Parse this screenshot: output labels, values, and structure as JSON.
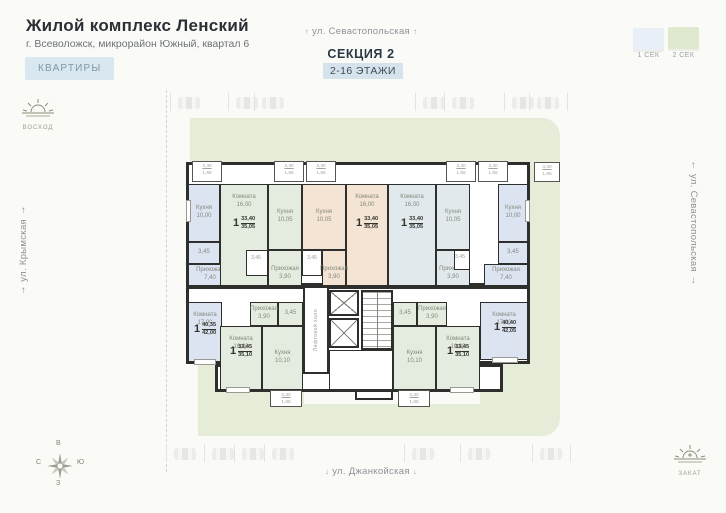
{
  "header": {
    "title": "Жилой комплекс Ленский",
    "subtitle": "г. Всеволожск, микрорайон Южный, квартал 6",
    "apartments_button": "КВАРТИРЫ"
  },
  "section": {
    "name": "СЕКЦИЯ 2",
    "floors": "2-16 ЭТАЖИ"
  },
  "legend": {
    "items": [
      {
        "label": "1 СЕК",
        "color": "#e9eff7"
      },
      {
        "label": "2 СЕК",
        "color": "#dfe9d0"
      }
    ]
  },
  "streets": {
    "top": "ул. Севастопольская",
    "left": "ул. Крымская",
    "right": "ул. Севастопольская",
    "bottom": "ул. Джанкойская",
    "arrow_up": "↑",
    "arrow_down": "↓"
  },
  "sun": {
    "sunrise": "ВОСХОД",
    "sunset": "ЗАКАТ"
  },
  "compass": {
    "top": "В",
    "left": "С",
    "right": "Ю",
    "bottom": "З"
  },
  "plan": {
    "core_label": "Лифтовой холл",
    "colors": {
      "wall": "#2e2e2c",
      "lawn": "#e5edd9",
      "sec1": "#dde4f1",
      "sec2": "#e4ecdf",
      "beige": "#f4e4d4",
      "pale": "#e1e9ec"
    },
    "lawns": [
      {
        "x": 32,
        "y": 30,
        "w": 370,
        "h": 46,
        "r": "0 18px 0 0"
      },
      {
        "x": 372,
        "y": 76,
        "w": 30,
        "h": 272,
        "r": "0 0 18px 0"
      },
      {
        "x": 40,
        "y": 276,
        "w": 106,
        "h": 72
      },
      {
        "x": 322,
        "y": 274,
        "w": 50,
        "h": 74
      },
      {
        "x": 40,
        "y": 316,
        "w": 332,
        "h": 32,
        "r": "0 0 18px 0"
      }
    ],
    "shells": [
      {
        "x": 28,
        "y": 74,
        "w": 344,
        "h": 124
      },
      {
        "x": 28,
        "y": 198,
        "w": 344,
        "h": 78
      },
      {
        "x": 57,
        "y": 276,
        "w": 288,
        "h": 28
      }
    ],
    "rooms": [
      {
        "n": "Кухня",
        "a": "10,00",
        "f": "blue",
        "x": 30,
        "y": 96,
        "w": 32,
        "h": 58
      },
      {
        "n": "",
        "a": "3,45",
        "f": "blue",
        "x": 30,
        "y": 154,
        "w": 32,
        "h": 22
      },
      {
        "n": "Прихожая",
        "a": "7,40",
        "f": "blue",
        "x": 30,
        "y": 176,
        "w": 44,
        "h": 22
      },
      {
        "n": "Комната",
        "a": "16,00",
        "f": "green",
        "x": 62,
        "y": 96,
        "w": 48,
        "h": 102,
        "lp": "t"
      },
      {
        "n": "Кухня",
        "a": "10,05",
        "f": "green",
        "x": 110,
        "y": 96,
        "w": 34,
        "h": 66
      },
      {
        "n": "",
        "a": "",
        "f": "white",
        "x": 88,
        "y": 162,
        "w": 22,
        "h": 26
      },
      {
        "n": "Прихожая",
        "a": "3,90",
        "f": "green",
        "x": 110,
        "y": 162,
        "w": 34,
        "h": 36,
        "lp": "b"
      },
      {
        "n": "Кухня",
        "a": "10,05",
        "f": "beige",
        "x": 144,
        "y": 96,
        "w": 44,
        "h": 66
      },
      {
        "n": "Комната",
        "a": "16,00",
        "f": "beige",
        "x": 188,
        "y": 96,
        "w": 42,
        "h": 102,
        "lp": "t"
      },
      {
        "n": "",
        "a": "",
        "f": "white",
        "x": 144,
        "y": 162,
        "w": 20,
        "h": 26
      },
      {
        "n": "Прихожая",
        "a": "3,90",
        "f": "beige",
        "x": 164,
        "y": 162,
        "w": 24,
        "h": 36,
        "lp": "b"
      },
      {
        "n": "Комната",
        "a": "16,00",
        "f": "pale",
        "x": 230,
        "y": 96,
        "w": 48,
        "h": 102,
        "lp": "t"
      },
      {
        "n": "Кухня",
        "a": "10,05",
        "f": "pale",
        "x": 278,
        "y": 96,
        "w": 34,
        "h": 66
      },
      {
        "n": "Прихожая",
        "a": "3,90",
        "f": "pale",
        "x": 278,
        "y": 162,
        "w": 34,
        "h": 36,
        "lp": "b"
      },
      {
        "n": "",
        "a": "",
        "f": "white",
        "x": 296,
        "y": 162,
        "w": 16,
        "h": 20
      },
      {
        "n": "Кухня",
        "a": "10,00",
        "f": "blue",
        "x": 340,
        "y": 96,
        "w": 30,
        "h": 58
      },
      {
        "n": "",
        "a": "3,45",
        "f": "blue",
        "x": 340,
        "y": 154,
        "w": 30,
        "h": 22
      },
      {
        "n": "Прихожая",
        "a": "7,40",
        "f": "blue",
        "x": 326,
        "y": 176,
        "w": 44,
        "h": 22
      },
      {
        "n": "Комната",
        "a": "17,00",
        "f": "blue",
        "x": 30,
        "y": 214,
        "w": 34,
        "h": 60,
        "lp": "t"
      },
      {
        "n": "Прихожая",
        "a": "3,90",
        "f": "green",
        "x": 92,
        "y": 214,
        "w": 28,
        "h": 24
      },
      {
        "n": "",
        "a": "3,45",
        "f": "green",
        "x": 120,
        "y": 214,
        "w": 25,
        "h": 24
      },
      {
        "n": "Комната",
        "a": "16,00",
        "f": "green",
        "x": 62,
        "y": 238,
        "w": 42,
        "h": 64,
        "lp": "t"
      },
      {
        "n": "Кухня",
        "a": "10,10",
        "f": "green",
        "x": 104,
        "y": 238,
        "w": 41,
        "h": 64
      },
      {
        "n": "",
        "a": "3,45",
        "f": "green",
        "x": 235,
        "y": 214,
        "w": 24,
        "h": 24
      },
      {
        "n": "Прихожая",
        "a": "3,90",
        "f": "green",
        "x": 259,
        "y": 214,
        "w": 30,
        "h": 24
      },
      {
        "n": "Кухня",
        "a": "10,10",
        "f": "green",
        "x": 235,
        "y": 238,
        "w": 43,
        "h": 64
      },
      {
        "n": "Комната",
        "a": "16,00",
        "f": "green",
        "x": 278,
        "y": 238,
        "w": 44,
        "h": 64,
        "lp": "t"
      },
      {
        "n": "Комната",
        "a": "17,00",
        "f": "blue",
        "x": 322,
        "y": 214,
        "w": 48,
        "h": 58,
        "lp": "t"
      }
    ],
    "dims": [
      {
        "t": "3,45",
        "x": 86,
        "y": 167,
        "w": 24
      },
      {
        "t": "3,45",
        "x": 142,
        "y": 167,
        "w": 24
      },
      {
        "t": "3,45",
        "x": 290,
        "y": 166,
        "w": 24
      }
    ],
    "badges": [
      {
        "rooms": "1",
        "top": "33,40",
        "bottom": "35,05",
        "x": 66,
        "y": 128,
        "w": 40
      },
      {
        "rooms": "1",
        "top": "33,40",
        "bottom": "35,05",
        "x": 189,
        "y": 128,
        "w": 40
      },
      {
        "rooms": "1",
        "top": "33,40",
        "bottom": "35,05",
        "x": 234,
        "y": 128,
        "w": 40
      },
      {
        "rooms": "1",
        "top": "40,35",
        "bottom": "42,00",
        "x": 28,
        "y": 234,
        "w": 38
      },
      {
        "rooms": "1",
        "top": "33,45",
        "bottom": "35,10",
        "x": 64,
        "y": 256,
        "w": 38
      },
      {
        "rooms": "1",
        "top": "33,45",
        "bottom": "35,10",
        "x": 280,
        "y": 256,
        "w": 40
      },
      {
        "rooms": "1",
        "top": "40,40",
        "bottom": "42,05",
        "x": 326,
        "y": 232,
        "w": 42
      }
    ],
    "balconies": [
      {
        "x": 34,
        "y": 73,
        "w": 30,
        "h": 21,
        "d1": "3,30",
        "d2": "1,65"
      },
      {
        "x": 116,
        "y": 73,
        "w": 30,
        "h": 21,
        "d1": "3,30",
        "d2": "1,65"
      },
      {
        "x": 148,
        "y": 73,
        "w": 30,
        "h": 21,
        "d1": "3,30",
        "d2": "1,65"
      },
      {
        "x": 288,
        "y": 73,
        "w": 30,
        "h": 21,
        "d1": "3,30",
        "d2": "1,65"
      },
      {
        "x": 320,
        "y": 73,
        "w": 30,
        "h": 21,
        "d1": "3,30",
        "d2": "1,65"
      },
      {
        "x": 376,
        "y": 74,
        "w": 26,
        "h": 20,
        "d1": "3,30",
        "d2": "1,65"
      },
      {
        "x": 112,
        "y": 302,
        "w": 32,
        "h": 17,
        "d1": "3,30",
        "d2": "1,65"
      },
      {
        "x": 240,
        "y": 302,
        "w": 32,
        "h": 17,
        "d1": "3,30",
        "d2": "1,65"
      }
    ],
    "windows": [
      {
        "x": 28,
        "y": 112,
        "w": 5,
        "h": 22
      },
      {
        "x": 367,
        "y": 112,
        "w": 5,
        "h": 22
      },
      {
        "x": 36,
        "y": 271,
        "w": 22,
        "h": 6
      },
      {
        "x": 334,
        "y": 269,
        "w": 26,
        "h": 6
      },
      {
        "x": 68,
        "y": 299,
        "w": 24,
        "h": 6
      },
      {
        "x": 292,
        "y": 299,
        "w": 24,
        "h": 6
      }
    ],
    "core": {
      "hall": {
        "x": 145,
        "y": 198,
        "w": 26,
        "h": 88
      },
      "lifts": [
        {
          "x": 171,
          "y": 202,
          "w": 30,
          "h": 26
        },
        {
          "x": 171,
          "y": 230,
          "w": 30,
          "h": 30
        }
      ],
      "stairs": {
        "x": 203,
        "y": 202,
        "w": 32,
        "h": 60
      },
      "vestibule": {
        "x": 171,
        "y": 262,
        "w": 64,
        "h": 40
      },
      "porch": {
        "x": 197,
        "y": 302,
        "w": 38,
        "h": 10
      }
    },
    "parking": {
      "top_y": 97,
      "bottom_y": 448,
      "top": [
        178,
        236,
        262,
        423,
        452,
        512,
        537
      ],
      "bottom": [
        174,
        212,
        242,
        272,
        412,
        468,
        540
      ]
    }
  }
}
